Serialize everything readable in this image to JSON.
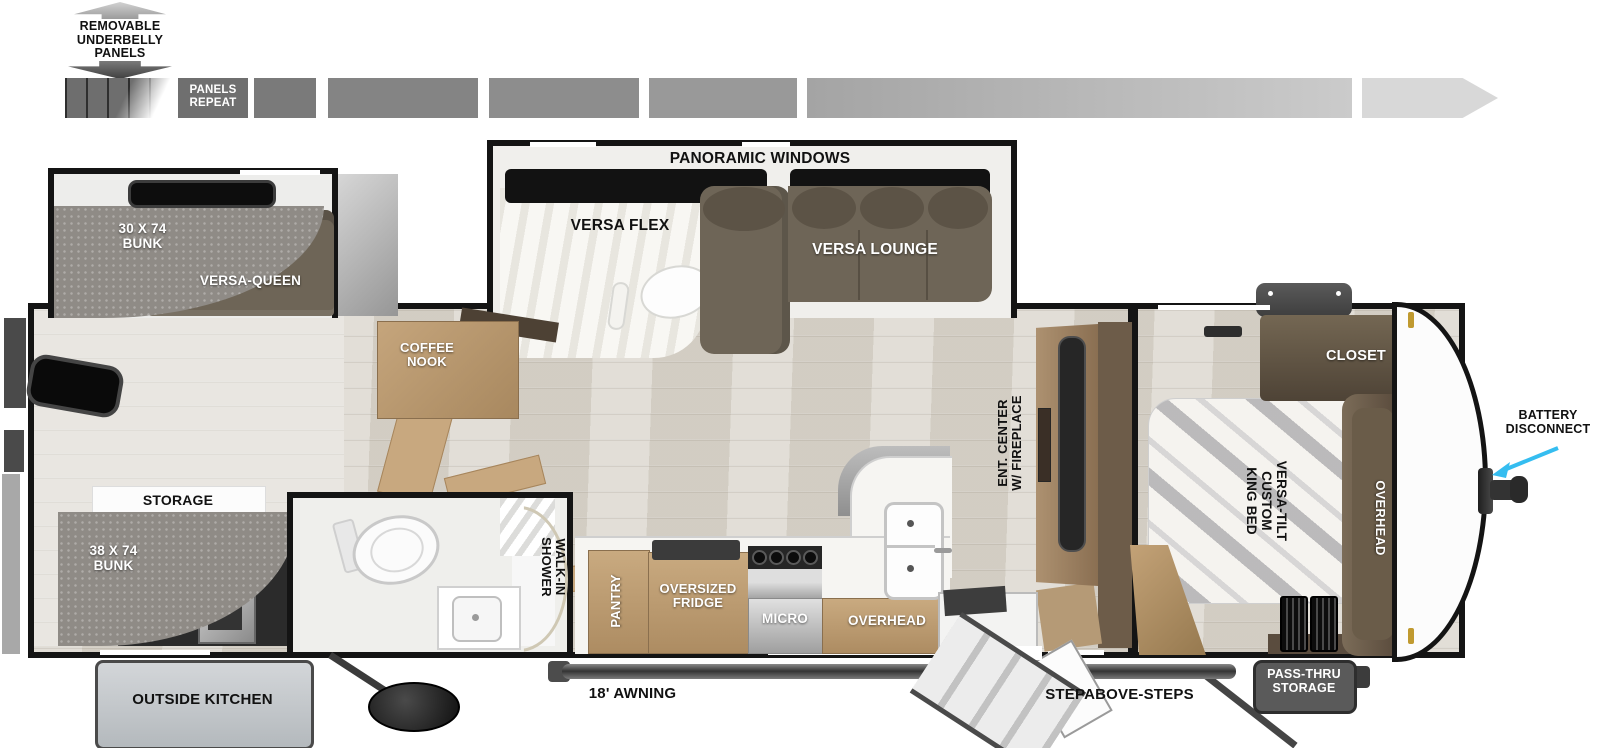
{
  "title": "Travel trailer floor plan",
  "labels": {
    "underbelly_note": "REMOVABLE\nUNDERBELLY\nPANELS",
    "panels_repeat": "PANELS\nREPEAT",
    "panoramic_windows": "PANORAMIC WINDOWS",
    "versa_flex": "VERSA FLEX",
    "versa_lounge": "VERSA LOUNGE",
    "bunk_30x74": "30 X 74\nBUNK",
    "versa_queen": "VERSA-QUEEN",
    "coffee_nook": "COFFEE\nNOOK",
    "storage": "STORAGE",
    "bunk_38x74": "38 X 74\nBUNK",
    "outside_kitchen": "OUTSIDE KITCHEN",
    "walk_in_shower": "WALK-IN\nSHOWER",
    "pantry": "PANTRY",
    "oversized_fridge": "OVERSIZED\nFRIDGE",
    "micro": "MICRO",
    "overhead_kitchen": "OVERHEAD",
    "ent_center": "ENT. CENTER\nW/ FIREPLACE",
    "king_bed": "VERSA-TILT\nCUSTOM\nKING BED",
    "closet": "CLOSET",
    "overhead_bedroom": "OVERHEAD",
    "awning": "18' AWNING",
    "steps": "STEPABOVE-STEPS",
    "pass_thru_storage": "PASS-THRU\nSTORAGE",
    "battery_disconnect": "BATTERY\nDISCONNECT"
  },
  "colors": {
    "wall": "#141414",
    "cabinet_tan": "#c2a178",
    "dark_cabinet_brown": "#5f5244",
    "sofa_brown": "#6e6557",
    "mattress_gray": "#8f8b86",
    "floor_wood": "#dbd6cd",
    "pointer_arrow_cyan": "#35bdf0",
    "outside_kitchen_box": "#c9cdd1",
    "pass_thru_box": "#5a5a5a",
    "marker_light_gold": "#c09a30"
  }
}
